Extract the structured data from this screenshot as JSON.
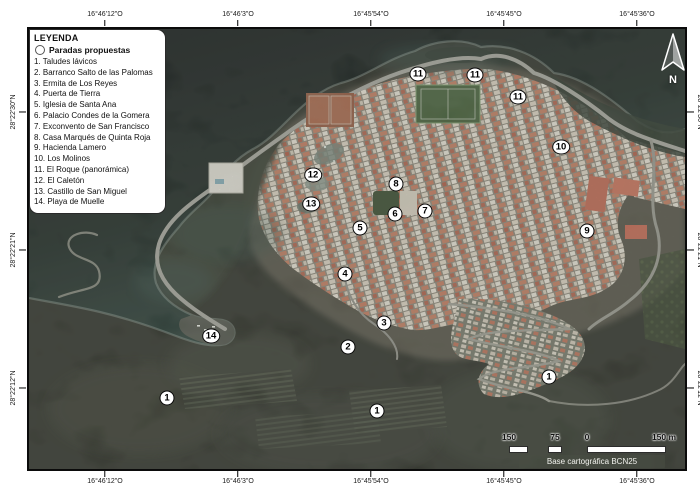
{
  "legend": {
    "title": "LEYENDA",
    "subtitle": "Paradas propuestas",
    "items": [
      "1. Taludes lávicos",
      "2. Barranco Salto de las Palomas",
      "3. Ermita de Los Reyes",
      "4. Puerta de Tierra",
      "5. Iglesia de Santa Ana",
      "6. Palacio Condes de la Gomera",
      "7. Exconvento de San Francisco",
      "8. Casa Marqués de Quinta Roja",
      "9. Hacienda Lamero",
      "10. Los Molinos",
      "11. El Roque (panorámica)",
      "12. El Caletón",
      "13. Castillo de San Miguel",
      "14. Playa de Muelle"
    ]
  },
  "axes": {
    "lon": [
      {
        "label": "16°46'12\"O",
        "x": 105
      },
      {
        "label": "16°46'3\"O",
        "x": 238
      },
      {
        "label": "16°45'54\"O",
        "x": 371
      },
      {
        "label": "16°45'45\"O",
        "x": 504
      },
      {
        "label": "16°45'36\"O",
        "x": 637
      }
    ],
    "lat": [
      {
        "label": "28°22'30\"N",
        "y": 112
      },
      {
        "label": "28°22'21\"N",
        "y": 250
      },
      {
        "label": "28°22'12\"N",
        "y": 388
      }
    ]
  },
  "markers": [
    {
      "label": "1",
      "x": 138,
      "y": 369
    },
    {
      "label": "1",
      "x": 348,
      "y": 382
    },
    {
      "label": "1",
      "x": 520,
      "y": 348
    },
    {
      "label": "2",
      "x": 319,
      "y": 318
    },
    {
      "label": "3",
      "x": 355,
      "y": 294
    },
    {
      "label": "4",
      "x": 316,
      "y": 245
    },
    {
      "label": "5",
      "x": 331,
      "y": 199
    },
    {
      "label": "6",
      "x": 366,
      "y": 185
    },
    {
      "label": "7",
      "x": 396,
      "y": 182
    },
    {
      "label": "8",
      "x": 367,
      "y": 155
    },
    {
      "label": "9",
      "x": 558,
      "y": 202
    },
    {
      "label": "10",
      "x": 532,
      "y": 118
    },
    {
      "label": "11",
      "x": 389,
      "y": 45
    },
    {
      "label": "11",
      "x": 446,
      "y": 46
    },
    {
      "label": "11",
      "x": 489,
      "y": 68
    },
    {
      "label": "12",
      "x": 284,
      "y": 146
    },
    {
      "label": "13",
      "x": 282,
      "y": 175
    },
    {
      "label": "14",
      "x": 182,
      "y": 307
    }
  ],
  "compass": {
    "label": "N"
  },
  "scalebar": {
    "ticks": [
      {
        "label": "150",
        "x": 2
      },
      {
        "label": "75",
        "x": 48
      },
      {
        "label": "0",
        "x": 80
      },
      {
        "label": "150 m",
        "x": 157
      }
    ]
  },
  "credit": {
    "text": "Base cartográfica BCN25"
  },
  "colors": {
    "ocean_dark": "#070c0a",
    "ocean_light": "#2b443d",
    "lava": "#23261f",
    "town_roof_red": "#c1765a",
    "town_light": "#dbd2c2",
    "field_green": "#3b5730",
    "marker_bg": "#ffffff",
    "marker_border": "#0a0a0a",
    "frame": "#0b0b0b"
  }
}
